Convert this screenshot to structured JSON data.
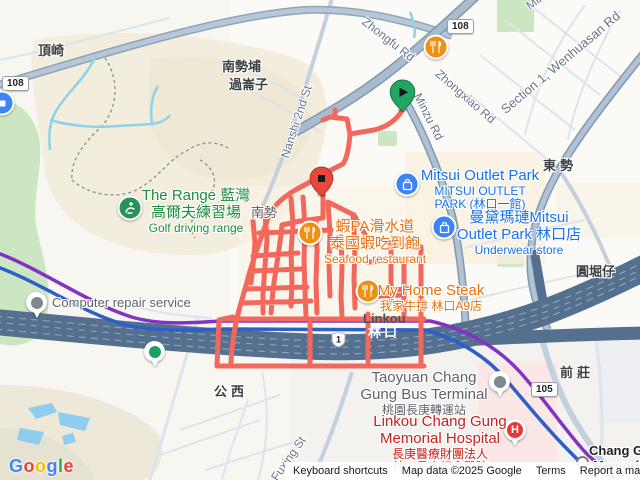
{
  "colors": {
    "route": "#f2685d",
    "route_start_pin": "#23a566",
    "route_end_pin": "#e8473d",
    "transit_purple": "#8133c4",
    "transit_blue": "#2d5fc7",
    "highway": "#54708e",
    "major_road": "#a9bccd",
    "poi_blue": "#3d85f4",
    "poi_orange": "#ef9013",
    "poi_green": "#259455",
    "poi_red": "#e53935"
  },
  "badges": {
    "route_108": "108",
    "route_105": "105",
    "hwy_1": "1"
  },
  "roads": {
    "zhongfu": "Zhongfu Rd",
    "zhongxiao": "Zhongxiao Rd",
    "minzu": "Minzu Rd",
    "minzu_corner": "Minzu Rd",
    "wenhuasan": "Section 1, Wenhuasan Rd",
    "nanshi": "Nanshi 2nd St",
    "fuxing": "Fuxing St"
  },
  "areas": {
    "dingqi": "頂崎",
    "nanshipu": "南勢埔",
    "guolunzi": "過崙子",
    "dongshi": "東勢",
    "yuankuzi": "圓堀仔",
    "qianzhuang": "前莊",
    "gongxi": "公西",
    "nanshi_street": "南勢",
    "linkou_en": "Linkou",
    "linkou_hwy": "林口"
  },
  "pois": {
    "golf": {
      "l1": "The Range 藍灣",
      "l2": "高爾夫練習場",
      "l3": "Golf driving range"
    },
    "mitsui1": {
      "l1": "Mitsui Outlet Park",
      "l2": "MITSUI OUTLET",
      "l3": "PARK (林口一館)"
    },
    "mitsui2": {
      "l1": "曼黛瑪璉Mitsui",
      "l2": "Outlet Park 林口店",
      "l3": "Underwear store"
    },
    "shrimp": {
      "l1": "蝦PA滑水道",
      "l2": "泰國蝦吃到飽",
      "l3": "Seafood restaurant"
    },
    "steak": {
      "l1": "My Home Steak",
      "l2": "我家牛排 林口A9店"
    },
    "repair": {
      "l1": "Computer repair service"
    },
    "terminal": {
      "l1": "Taoyuan Chang",
      "l2": "Gung Bus Terminal",
      "l3": "桃園長庚轉運站"
    },
    "hospital": {
      "l1": "Linkou Chang Gung",
      "l2": "Memorial Hospital",
      "l3": "長庚醫療財團法人",
      "l4": "林口長庚紀念醫院"
    },
    "station": {
      "l1": "Chang Gung",
      "l2": "Memorial",
      "h_glyph": "H"
    }
  },
  "attribution": {
    "shortcuts": "Keyboard shortcuts",
    "mapdata": "Map data ©2025 Google",
    "terms": "Terms",
    "report": "Report a map error"
  },
  "google": {
    "letters": [
      {
        "ch": "G",
        "style": "color:#4285F4"
      },
      {
        "ch": "o",
        "style": "color:#EA4335"
      },
      {
        "ch": "o",
        "style": "color:#FBBC05"
      },
      {
        "ch": "g",
        "style": "color:#4285F4"
      },
      {
        "ch": "l",
        "style": "color:#34A853"
      },
      {
        "ch": "e",
        "style": "color:#EA4335"
      }
    ]
  }
}
